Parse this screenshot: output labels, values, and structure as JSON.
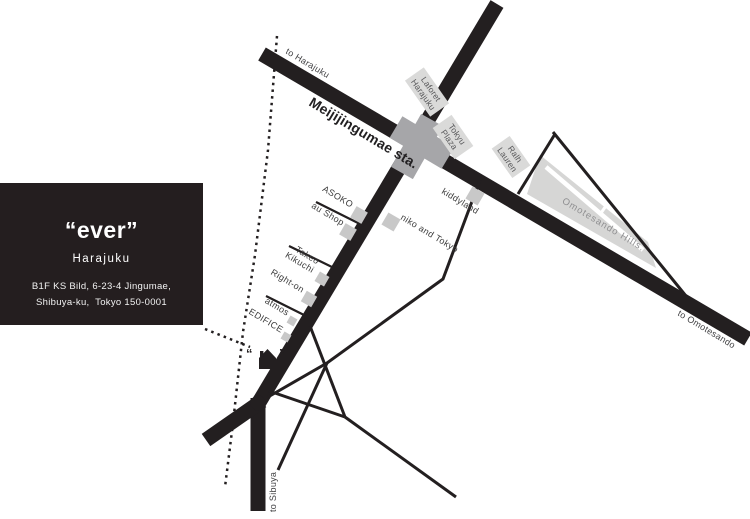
{
  "map": {
    "info_card": {
      "title": "“ever”",
      "subtitle": "Harajuku",
      "address_line1": "B1F KS Bild, 6-23-4 Jingumae,",
      "address_line2": "Shibuya-ku,  Tokyo 150-0001"
    },
    "station_label": "Meijijingumae sta.",
    "directions": {
      "harajuku": "to Harajuku",
      "omotesando": "to Omotesando",
      "shibuya": "to Sibuya"
    },
    "landmarks": {
      "laforet_line1": "Laforet",
      "laforet_line2": "Harajuku",
      "tokyu_line1": "Tokyu",
      "tokyu_line2": "Plaza",
      "ralph_line1": "Ralh",
      "ralph_line2": "Lauren",
      "omotesando_hills": "Omotesando Hills.",
      "kiddyland": "kiddyland",
      "niko_and_tokyo": "niko and Tokyo"
    },
    "shops": {
      "asoko": "ASOKO",
      "au_shop": "au Shop",
      "takeo_line1": "Takeo",
      "takeo_line2": "Kikuchi",
      "right_on": "Right-on",
      "atmos": "atmos",
      "edifice": "EDIFICE"
    },
    "marker": {
      "quote_open": "“",
      "quote_close": "”"
    },
    "colors": {
      "road_black": "#231f20",
      "station_gray": "#a6a6a9",
      "label_box_gray": "#dadad9",
      "shop_square_gray": "#c8c8c8",
      "hills_gray": "#d6d6d5",
      "card_background": "#241e1f"
    }
  }
}
